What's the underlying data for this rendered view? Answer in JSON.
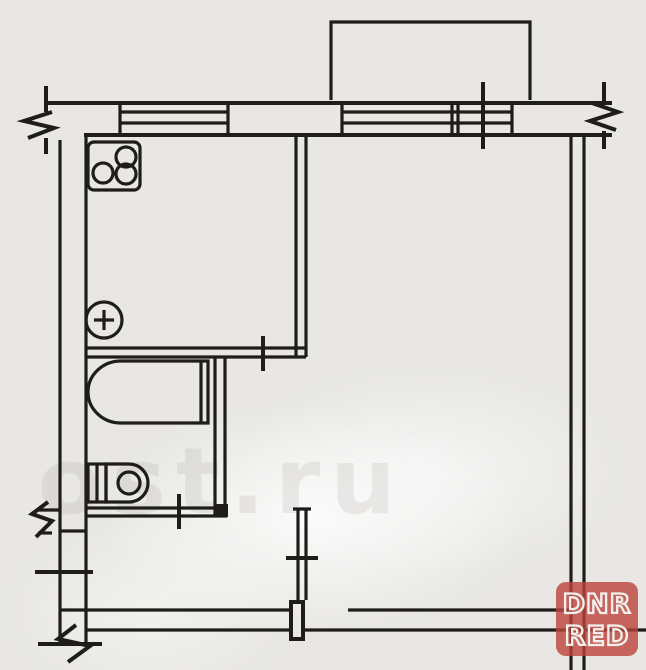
{
  "plan": {
    "kind_label": "",
    "rooms_note": ""
  },
  "watermark": {
    "text": "ost.ru"
  },
  "logo": {
    "line1": "DNR",
    "line2": "RED"
  },
  "colors": {
    "line-color": "#1f1d1b",
    "paper": "#e8e7e4",
    "paper-light": "#f7f6f3",
    "logo-red": "rgba(187,68,58,0.80)",
    "logo-outline": "#f2efec",
    "watermark-color": "rgba(120,118,110,0.12)"
  }
}
